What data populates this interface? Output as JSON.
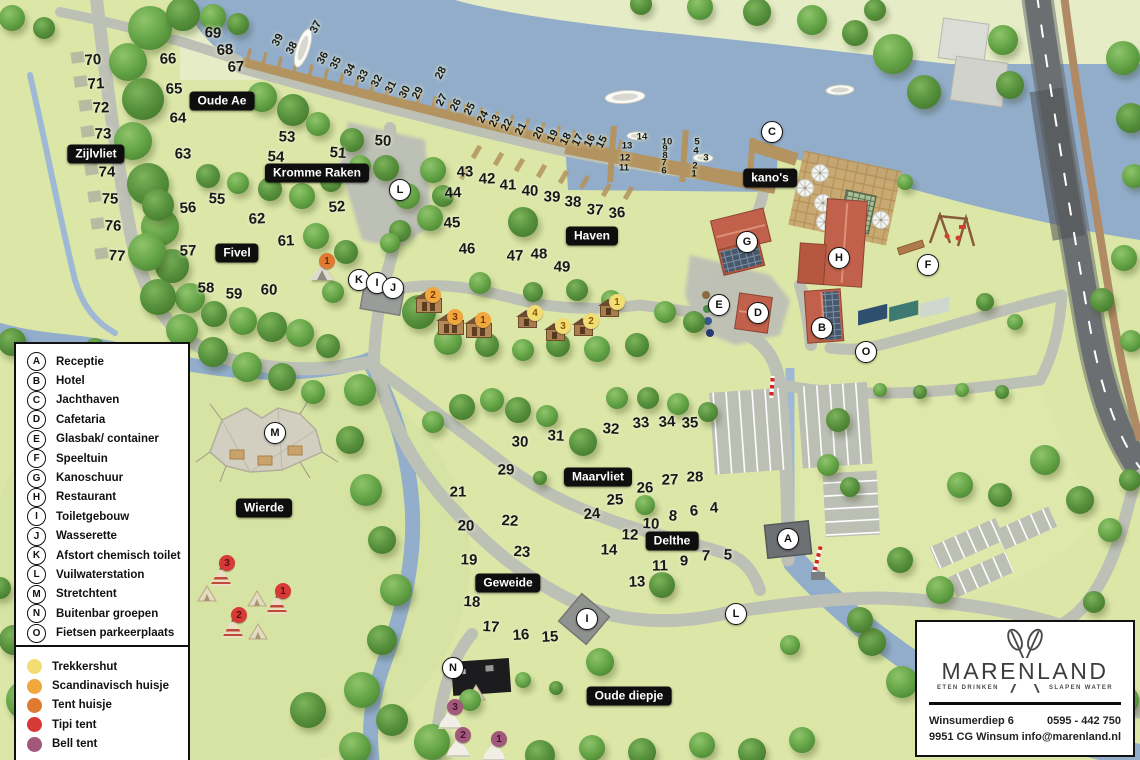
{
  "map": {
    "region_labels": [
      {
        "text": "Zijlvliet",
        "x": 96,
        "y": 154
      },
      {
        "text": "Oude Ae",
        "x": 222,
        "y": 101
      },
      {
        "text": "Kromme Raken",
        "x": 317,
        "y": 173
      },
      {
        "text": "Fivel",
        "x": 237,
        "y": 253
      },
      {
        "text": "Haven",
        "x": 592,
        "y": 236
      },
      {
        "text": "kano's",
        "x": 770,
        "y": 178
      },
      {
        "text": "Wierde",
        "x": 264,
        "y": 508
      },
      {
        "text": "Maarvliet",
        "x": 598,
        "y": 477
      },
      {
        "text": "Delthe",
        "x": 672,
        "y": 541
      },
      {
        "text": "Geweide",
        "x": 508,
        "y": 583
      },
      {
        "text": "Oude diepje",
        "x": 629,
        "y": 696
      }
    ],
    "facility_markers": [
      {
        "letter": "C",
        "x": 772,
        "y": 132
      },
      {
        "letter": "L",
        "x": 400,
        "y": 190
      },
      {
        "letter": "K",
        "x": 359,
        "y": 280
      },
      {
        "letter": "I",
        "x": 377,
        "y": 283
      },
      {
        "letter": "J",
        "x": 393,
        "y": 288
      },
      {
        "letter": "G",
        "x": 747,
        "y": 242
      },
      {
        "letter": "H",
        "x": 839,
        "y": 258
      },
      {
        "letter": "E",
        "x": 719,
        "y": 305
      },
      {
        "letter": "D",
        "x": 758,
        "y": 313
      },
      {
        "letter": "B",
        "x": 822,
        "y": 328
      },
      {
        "letter": "F",
        "x": 928,
        "y": 265
      },
      {
        "letter": "O",
        "x": 866,
        "y": 352
      },
      {
        "letter": "M",
        "x": 275,
        "y": 433
      },
      {
        "letter": "A",
        "x": 788,
        "y": 539
      },
      {
        "letter": "I",
        "x": 587,
        "y": 619
      },
      {
        "letter": "L",
        "x": 736,
        "y": 614
      },
      {
        "letter": "N",
        "x": 453,
        "y": 668
      }
    ],
    "pitch_numbers": [
      {
        "n": 70,
        "x": 93,
        "y": 60
      },
      {
        "n": 71,
        "x": 96,
        "y": 84
      },
      {
        "n": 72,
        "x": 101,
        "y": 108
      },
      {
        "n": 73,
        "x": 103,
        "y": 134
      },
      {
        "n": 74,
        "x": 107,
        "y": 172
      },
      {
        "n": 75,
        "x": 110,
        "y": 199
      },
      {
        "n": 76,
        "x": 113,
        "y": 226
      },
      {
        "n": 77,
        "x": 117,
        "y": 256
      },
      {
        "n": 69,
        "x": 213,
        "y": 33
      },
      {
        "n": 68,
        "x": 225,
        "y": 50
      },
      {
        "n": 67,
        "x": 236,
        "y": 67
      },
      {
        "n": 66,
        "x": 168,
        "y": 59
      },
      {
        "n": 65,
        "x": 174,
        "y": 89
      },
      {
        "n": 64,
        "x": 178,
        "y": 118
      },
      {
        "n": 63,
        "x": 183,
        "y": 154
      },
      {
        "n": 53,
        "x": 287,
        "y": 137
      },
      {
        "n": 54,
        "x": 276,
        "y": 157
      },
      {
        "n": 55,
        "x": 217,
        "y": 199
      },
      {
        "n": 56,
        "x": 188,
        "y": 208
      },
      {
        "n": 62,
        "x": 257,
        "y": 219
      },
      {
        "n": 61,
        "x": 286,
        "y": 241
      },
      {
        "n": 57,
        "x": 188,
        "y": 251
      },
      {
        "n": 58,
        "x": 206,
        "y": 288
      },
      {
        "n": 59,
        "x": 234,
        "y": 294
      },
      {
        "n": 60,
        "x": 269,
        "y": 290
      },
      {
        "n": 50,
        "x": 383,
        "y": 141
      },
      {
        "n": 51,
        "x": 338,
        "y": 153
      },
      {
        "n": 52,
        "x": 337,
        "y": 207
      },
      {
        "n": 44,
        "x": 453,
        "y": 193
      },
      {
        "n": 43,
        "x": 465,
        "y": 172
      },
      {
        "n": 42,
        "x": 487,
        "y": 179
      },
      {
        "n": 41,
        "x": 508,
        "y": 185
      },
      {
        "n": 40,
        "x": 530,
        "y": 191
      },
      {
        "n": 39,
        "x": 552,
        "y": 197
      },
      {
        "n": 38,
        "x": 573,
        "y": 202
      },
      {
        "n": 37,
        "x": 595,
        "y": 210
      },
      {
        "n": 36,
        "x": 617,
        "y": 213
      },
      {
        "n": 45,
        "x": 452,
        "y": 223
      },
      {
        "n": 46,
        "x": 467,
        "y": 249
      },
      {
        "n": 47,
        "x": 515,
        "y": 256
      },
      {
        "n": 48,
        "x": 539,
        "y": 254
      },
      {
        "n": 49,
        "x": 562,
        "y": 267
      },
      {
        "n": 30,
        "x": 520,
        "y": 442
      },
      {
        "n": 31,
        "x": 556,
        "y": 436
      },
      {
        "n": 32,
        "x": 611,
        "y": 429
      },
      {
        "n": 33,
        "x": 641,
        "y": 423
      },
      {
        "n": 34,
        "x": 667,
        "y": 422
      },
      {
        "n": 35,
        "x": 690,
        "y": 423
      },
      {
        "n": 29,
        "x": 506,
        "y": 470
      },
      {
        "n": 21,
        "x": 458,
        "y": 492
      },
      {
        "n": 20,
        "x": 466,
        "y": 526
      },
      {
        "n": 19,
        "x": 469,
        "y": 560
      },
      {
        "n": 22,
        "x": 510,
        "y": 521
      },
      {
        "n": 23,
        "x": 522,
        "y": 552
      },
      {
        "n": 24,
        "x": 592,
        "y": 514
      },
      {
        "n": 25,
        "x": 615,
        "y": 500
      },
      {
        "n": 26,
        "x": 645,
        "y": 488
      },
      {
        "n": 27,
        "x": 670,
        "y": 480
      },
      {
        "n": 28,
        "x": 695,
        "y": 477
      },
      {
        "n": 14,
        "x": 609,
        "y": 550
      },
      {
        "n": 12,
        "x": 630,
        "y": 535
      },
      {
        "n": 10,
        "x": 651,
        "y": 524
      },
      {
        "n": 8,
        "x": 673,
        "y": 516
      },
      {
        "n": 6,
        "x": 694,
        "y": 511
      },
      {
        "n": 4,
        "x": 714,
        "y": 508
      },
      {
        "n": 13,
        "x": 637,
        "y": 582
      },
      {
        "n": 11,
        "x": 660,
        "y": 566
      },
      {
        "n": 9,
        "x": 684,
        "y": 561
      },
      {
        "n": 7,
        "x": 706,
        "y": 556
      },
      {
        "n": 5,
        "x": 728,
        "y": 555
      },
      {
        "n": 18,
        "x": 472,
        "y": 602
      },
      {
        "n": 17,
        "x": 491,
        "y": 627
      },
      {
        "n": 16,
        "x": 521,
        "y": 635
      },
      {
        "n": 15,
        "x": 550,
        "y": 637
      }
    ],
    "dock_numbers": [
      {
        "n": 39,
        "x": 278,
        "y": 40
      },
      {
        "n": 38,
        "x": 292,
        "y": 48
      },
      {
        "n": 37,
        "x": 316,
        "y": 27
      },
      {
        "n": 36,
        "x": 323,
        "y": 58
      },
      {
        "n": 35,
        "x": 336,
        "y": 63
      },
      {
        "n": 34,
        "x": 350,
        "y": 70
      },
      {
        "n": 33,
        "x": 363,
        "y": 76
      },
      {
        "n": 32,
        "x": 377,
        "y": 81
      },
      {
        "n": 31,
        "x": 391,
        "y": 87
      },
      {
        "n": 30,
        "x": 405,
        "y": 92
      },
      {
        "n": 29,
        "x": 418,
        "y": 93
      },
      {
        "n": 28,
        "x": 441,
        "y": 73
      },
      {
        "n": 27,
        "x": 442,
        "y": 100
      },
      {
        "n": 26,
        "x": 456,
        "y": 105
      },
      {
        "n": 25,
        "x": 470,
        "y": 109
      },
      {
        "n": 24,
        "x": 483,
        "y": 117
      },
      {
        "n": 23,
        "x": 495,
        "y": 121
      },
      {
        "n": 22,
        "x": 507,
        "y": 125
      },
      {
        "n": 21,
        "x": 521,
        "y": 129
      },
      {
        "n": 20,
        "x": 539,
        "y": 133
      },
      {
        "n": 19,
        "x": 553,
        "y": 136
      },
      {
        "n": 18,
        "x": 566,
        "y": 139
      },
      {
        "n": 17,
        "x": 578,
        "y": 140
      },
      {
        "n": 16,
        "x": 590,
        "y": 141
      },
      {
        "n": 15,
        "x": 602,
        "y": 142
      }
    ],
    "marina_numbers": [
      {
        "n": 14,
        "x": 642,
        "y": 137
      },
      {
        "n": 13,
        "x": 627,
        "y": 146
      },
      {
        "n": 12,
        "x": 625,
        "y": 158
      },
      {
        "n": 11,
        "x": 624,
        "y": 168
      },
      {
        "n": 10,
        "x": 667,
        "y": 142
      },
      {
        "n": 9,
        "x": 665,
        "y": 149
      },
      {
        "n": 8,
        "x": 665,
        "y": 156
      },
      {
        "n": 7,
        "x": 664,
        "y": 163
      },
      {
        "n": 6,
        "x": 664,
        "y": 171
      },
      {
        "n": 5,
        "x": 697,
        "y": 142
      },
      {
        "n": 4,
        "x": 696,
        "y": 151
      },
      {
        "n": 3,
        "x": 706,
        "y": 158
      },
      {
        "n": 2,
        "x": 695,
        "y": 166
      },
      {
        "n": 1,
        "x": 694,
        "y": 174
      }
    ],
    "accommodations": [
      {
        "type": "scandinavisch",
        "n": 2,
        "x": 428,
        "y": 306
      },
      {
        "type": "scandinavisch",
        "n": 3,
        "x": 450,
        "y": 328
      },
      {
        "type": "scandinavisch",
        "n": 1,
        "x": 478,
        "y": 331
      },
      {
        "type": "trekkershut",
        "n": 4,
        "x": 530,
        "y": 324
      },
      {
        "type": "trekkershut",
        "n": 3,
        "x": 558,
        "y": 337
      },
      {
        "type": "trekkershut",
        "n": 2,
        "x": 586,
        "y": 332
      },
      {
        "type": "trekkershut",
        "n": 1,
        "x": 612,
        "y": 313
      },
      {
        "type": "tenthuisje",
        "n": 1,
        "x": 322,
        "y": 272
      },
      {
        "type": "tipi",
        "n": 3,
        "x": 222,
        "y": 574
      },
      {
        "type": "tipi",
        "n": 1,
        "x": 278,
        "y": 602
      },
      {
        "type": "tipi",
        "n": 2,
        "x": 234,
        "y": 626
      },
      {
        "type": "bell",
        "n": 3,
        "x": 450,
        "y": 718
      },
      {
        "type": "bell",
        "n": 2,
        "x": 458,
        "y": 746
      },
      {
        "type": "bell",
        "n": 1,
        "x": 494,
        "y": 750
      }
    ]
  },
  "legend": {
    "facilities": [
      {
        "letter": "A",
        "label": "Receptie"
      },
      {
        "letter": "B",
        "label": "Hotel"
      },
      {
        "letter": "C",
        "label": "Jachthaven"
      },
      {
        "letter": "D",
        "label": "Cafetaria"
      },
      {
        "letter": "E",
        "label": "Glasbak/ container"
      },
      {
        "letter": "F",
        "label": "Speeltuin"
      },
      {
        "letter": "G",
        "label": "Kanoschuur"
      },
      {
        "letter": "H",
        "label": "Restaurant"
      },
      {
        "letter": "I",
        "label": "Toiletgebouw"
      },
      {
        "letter": "J",
        "label": "Wasserette"
      },
      {
        "letter": "K",
        "label": "Afstort chemisch toilet"
      },
      {
        "letter": "L",
        "label": "Vuilwaterstation"
      },
      {
        "letter": "M",
        "label": "Stretchtent"
      },
      {
        "letter": "N",
        "label": "Buitenbar groepen"
      },
      {
        "letter": "O",
        "label": "Fietsen parkeerplaats"
      }
    ],
    "accommodation_types": [
      {
        "key": "trekkershut",
        "label": "Trekkershut",
        "color": "#F2DC74",
        "text_color": "#8a5a00"
      },
      {
        "key": "scandinavisch",
        "label": "Scandinavisch huisje",
        "color": "#EFA73E",
        "text_color": "#7a3500"
      },
      {
        "key": "tenthuisje",
        "label": "Tent huisje",
        "color": "#DF7A31",
        "text_color": "#6b2d00"
      },
      {
        "key": "tipi",
        "label": "Tipi tent",
        "color": "#D63936",
        "text_color": "#5c1010"
      },
      {
        "key": "bell",
        "label": "Bell tent",
        "color": "#A2587A",
        "text_color": "#43132b"
      }
    ]
  },
  "info_card": {
    "brand": "MARENLAND",
    "tagline_left": "ETEN DRINKEN",
    "tagline_right": "SLAPEN WATER",
    "address_line1": "Winsumerdiep 6",
    "address_line2": "9951 CG Winsum",
    "phone": "0595 - 442 750",
    "email": "info@marenland.nl"
  }
}
